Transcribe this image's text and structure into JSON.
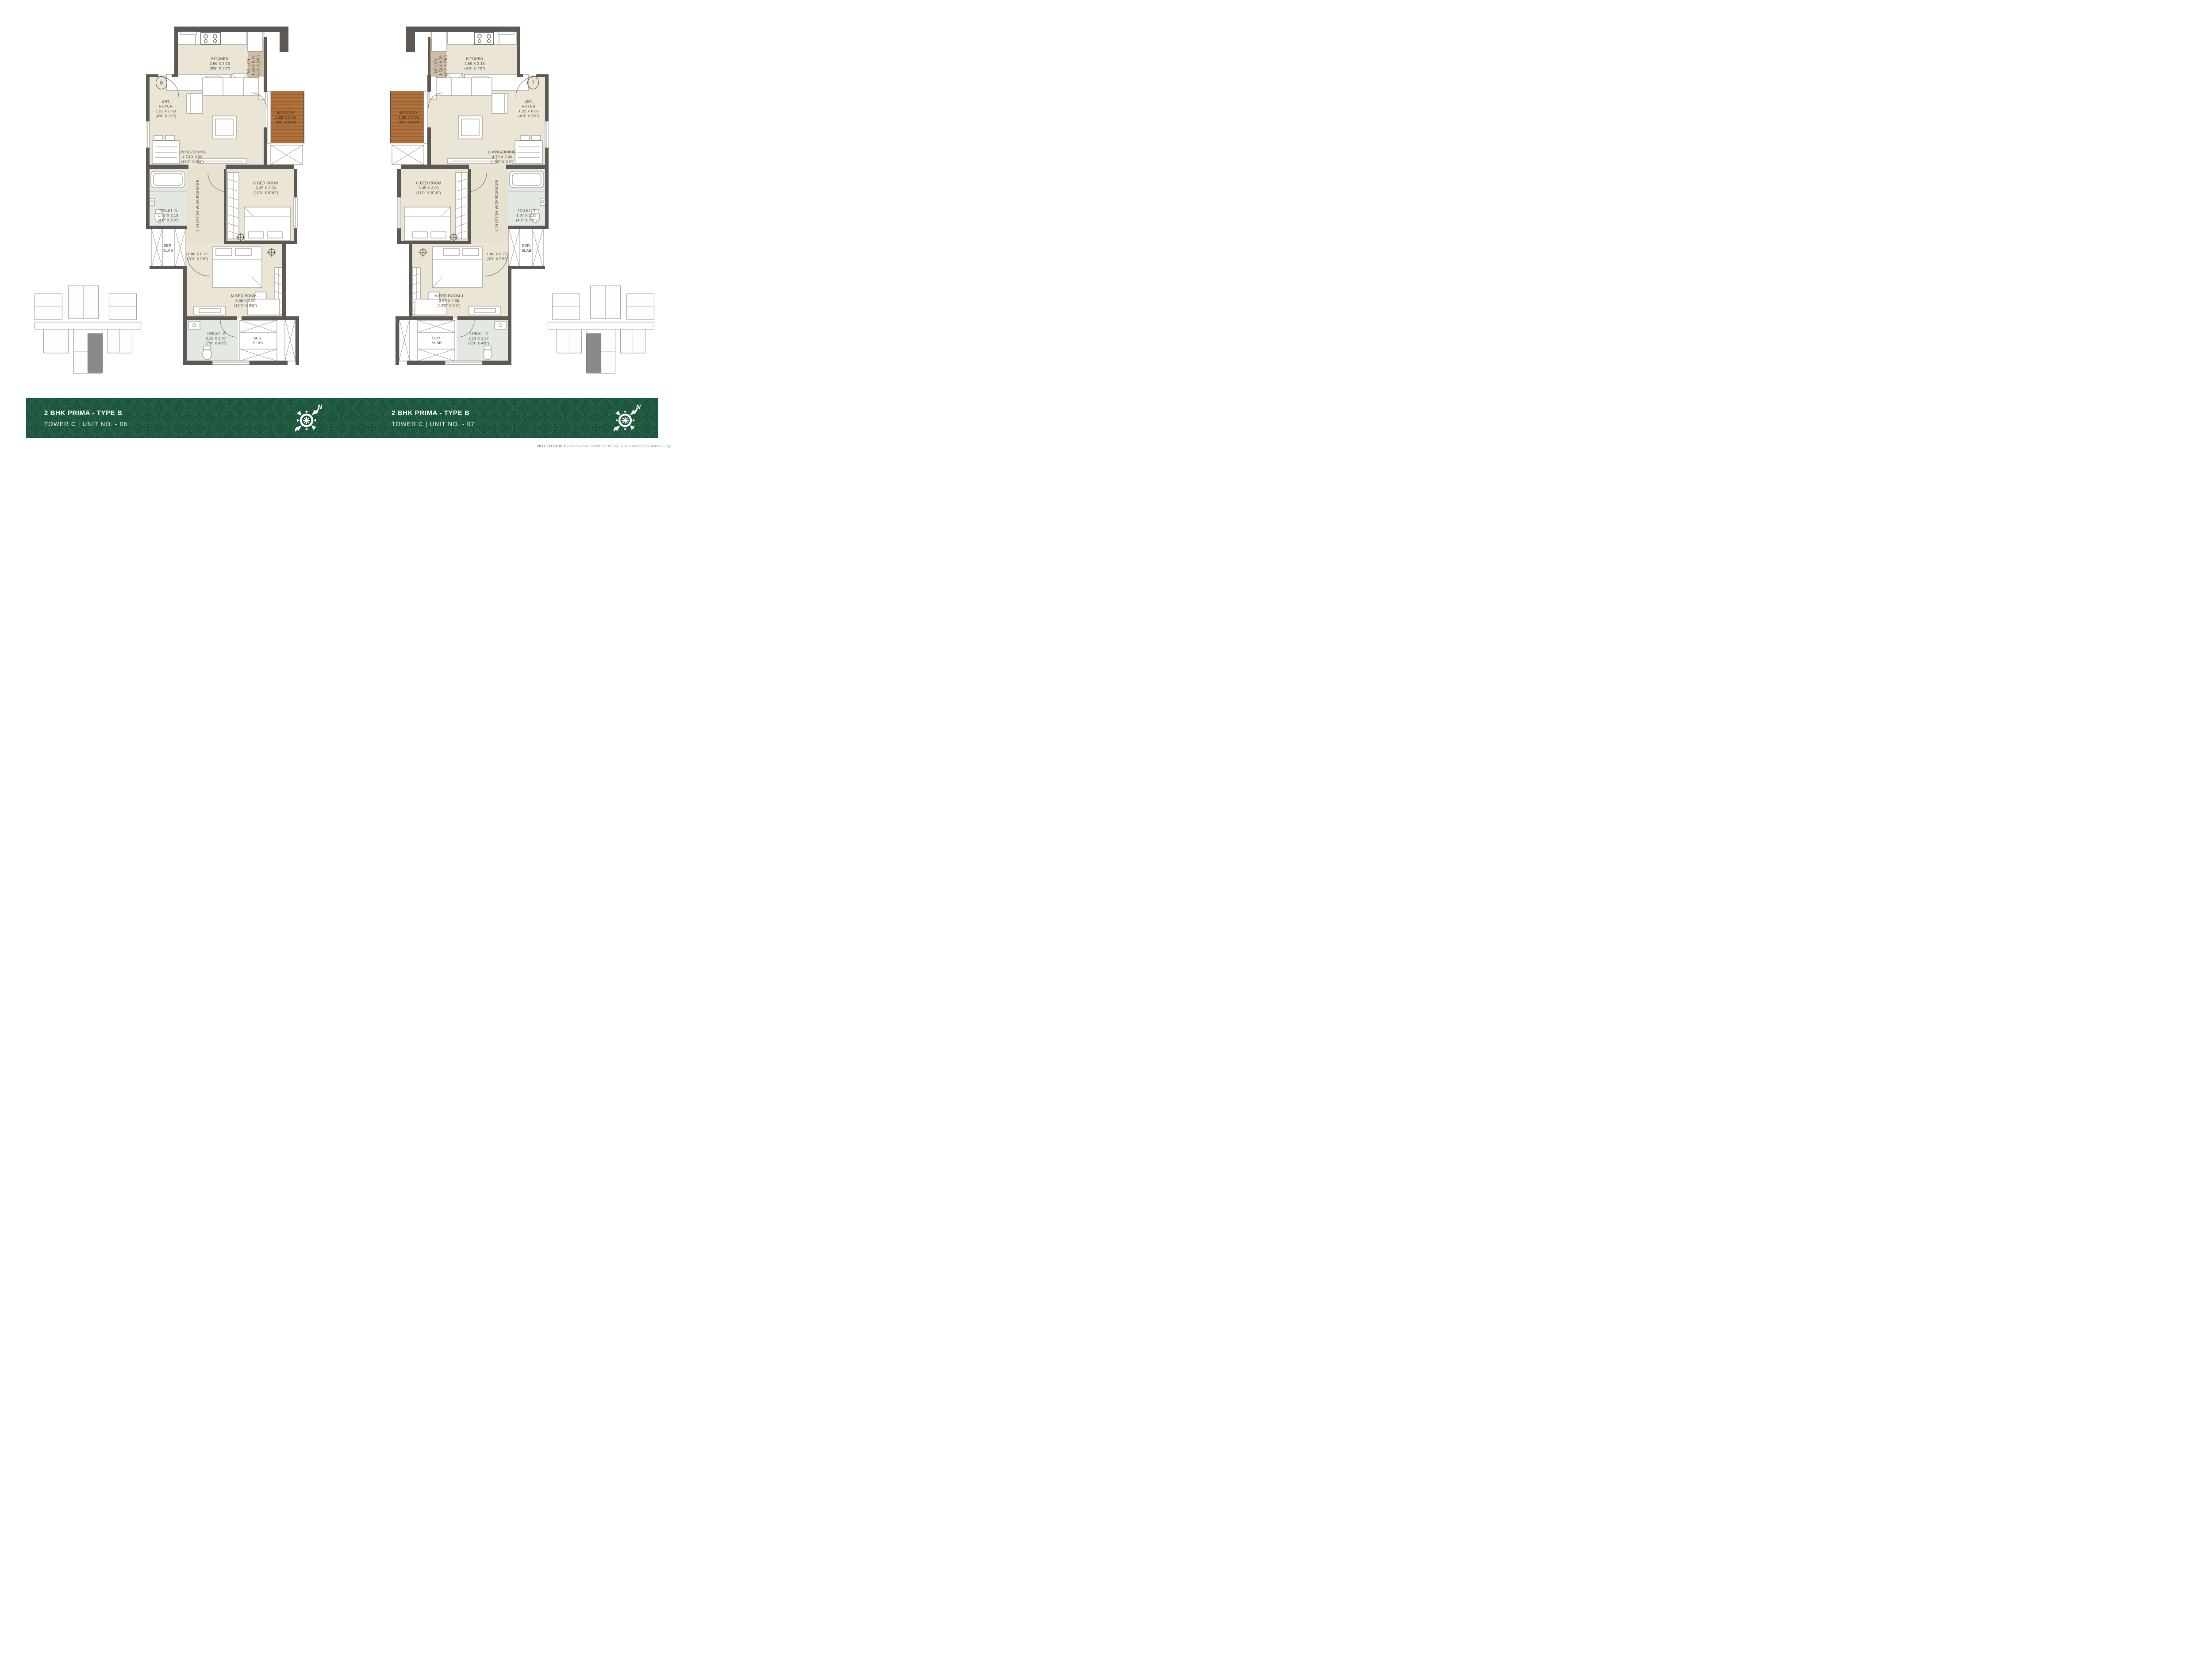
{
  "footer": {
    "bg_color": "#175339",
    "panels": [
      {
        "title": "2 BHK PRIMA  - TYPE B",
        "subtitle": "TOWER C | UNIT NO. - 06"
      },
      {
        "title": "2 BHK PRIMA  - TYPE B",
        "subtitle": "TOWER C | UNIT NO. - 07"
      }
    ],
    "compass_label": "N"
  },
  "disclaimer": {
    "bold": "NOT TO SCALE |",
    "rest": " Disclaimer: CONFIDENTIAL. For Internal Circulation Only."
  },
  "units": [
    {
      "unit_number": "6",
      "labels": {
        "kitchen": {
          "name": "KITCHEN",
          "dim_m": "2.59 X 2.13",
          "dim_ft": "(8'6\" X 7'0\")"
        },
        "utility": {
          "name": "UTILITY",
          "dim_m": "1.53 X 0.76",
          "dim_ft": "(5'0\" X 2'6\")"
        },
        "ent_foyer": {
          "line1": "ENT.",
          "line2": "FOYER",
          "dim_m": "1.22 X 0.60",
          "dim_ft": "(4'0\" X 2'0\")"
        },
        "balcony": {
          "name": "BALCONY",
          "dim_m": "1.05 X 1.95",
          "dim_ft": "(3'5\" X 6'5\")"
        },
        "living": {
          "name": "LIVING/DINING",
          "dim_m": "4.73 X 2.90",
          "dim_ft": "(15'6\" X 9'6\")"
        },
        "toilet1": {
          "name": "TOILET -1",
          "dim_m": "1.37 X 2.13",
          "dim_ft": "(4'6\" X 7'0\")"
        },
        "ser_slab1": {
          "line1": "SER.",
          "line2": "SLAB"
        },
        "passage": {
          "text": "1.00 (3'3\")M.WIDE PASSAGE"
        },
        "cbed": {
          "name": "C.BED ROOM",
          "dim_m": "3.35 X 3.00",
          "dim_ft": "(11'0\" X 9'10\")"
        },
        "niche": {
          "dim_m": "1.00 X 0.77",
          "dim_ft": "(3'3\" X 2'6\")"
        },
        "mbed": {
          "name": "M.BED ROOM-1",
          "dim_m": "3.65 X 2.90",
          "dim_ft": "(12'0\" X 9'6\")"
        },
        "toilet2": {
          "name": "TOILET -2",
          "dim_m": "2.13 X 1.37",
          "dim_ft": "(7'0\" X 4'6\")"
        },
        "ser_slab2": {
          "line1": "SER.",
          "line2": "SLAB"
        }
      }
    },
    {
      "unit_number": "7",
      "labels": {
        "kitchen": {
          "name": "KITCHEN",
          "dim_m": "2.59 X 2.13",
          "dim_ft": "(8'6\" X 7'0\")"
        },
        "utility": {
          "name": "UTILITY",
          "dim_m": "1.53 X 0.76",
          "dim_ft": "(5'0\" X 2'6\")"
        },
        "ent_foyer": {
          "line1": "ENT.",
          "line2": "FOYER",
          "dim_m": "1.22 X 0.60",
          "dim_ft": "(4'0\" X 2'0\")"
        },
        "balcony": {
          "name": "BALCONY",
          "dim_m": "1.05 X 1.95",
          "dim_ft": "(3'5\" X 6'5\")"
        },
        "living": {
          "name": "LIVING/DINING",
          "dim_m": "4.73 X 2.90",
          "dim_ft": "(15'6\" X 9'6\")"
        },
        "toilet1": {
          "name": "TOILET -1",
          "dim_m": "1.37 X 2.13",
          "dim_ft": "(4'6\" X 7'0\")"
        },
        "ser_slab1": {
          "line1": "SER.",
          "line2": "SLAB"
        },
        "passage": {
          "text": "1.00 (3'3\")M.WIDE PASSAGE"
        },
        "cbed": {
          "name": "C.BED ROOM",
          "dim_m": "3.35 X 3.00",
          "dim_ft": "(11'0\" X 9'10\")"
        },
        "niche": {
          "dim_m": "1.00 X 0.77",
          "dim_ft": "(3'3\" X 2'6\")"
        },
        "mbed": {
          "name": "M.BED ROOM-1",
          "dim_m": "3.65 X 2.90",
          "dim_ft": "(12'0\" X 9'6\")"
        },
        "toilet2": {
          "name": "TOILET -2",
          "dim_m": "2.13 X 1.37",
          "dim_ft": "(7'0\" X 4'6\")"
        },
        "ser_slab2": {
          "line1": "SER.",
          "line2": "SLAB"
        }
      }
    }
  ]
}
